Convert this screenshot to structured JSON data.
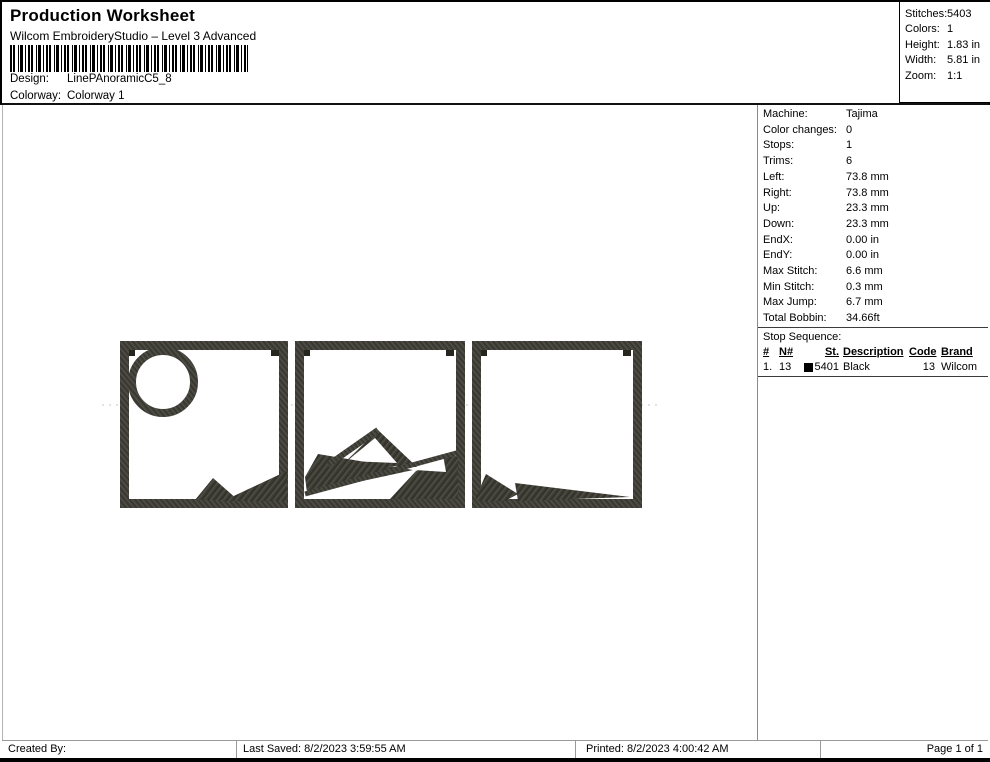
{
  "header": {
    "title": "Production Worksheet",
    "subtitle": "Wilcom EmbroideryStudio – Level 3 Advanced",
    "design_label": "Design:",
    "design_value": "LinePAnoramicC5_8",
    "colorway_label": "Colorway:",
    "colorway_value": "Colorway 1",
    "stats": [
      {
        "label": "Stitches:",
        "value": "5403"
      },
      {
        "label": "Colors:",
        "value": "1"
      },
      {
        "label": "Height:",
        "value": "1.83 in"
      },
      {
        "label": "Width:",
        "value": "5.81 in"
      },
      {
        "label": "Zoom:",
        "value": "1:1"
      }
    ]
  },
  "machine": {
    "rows": [
      {
        "label": "Machine:",
        "value": "Tajima"
      },
      {
        "label": "Color changes:",
        "value": "0"
      },
      {
        "label": "Stops:",
        "value": "1"
      },
      {
        "label": "Trims:",
        "value": "6"
      },
      {
        "label": "Left:",
        "value": "73.8 mm"
      },
      {
        "label": "Right:",
        "value": "73.8 mm"
      },
      {
        "label": "Up:",
        "value": "23.3 mm"
      },
      {
        "label": "Down:",
        "value": "23.3 mm"
      },
      {
        "label": "EndX:",
        "value": "0.00 in"
      },
      {
        "label": "EndY:",
        "value": "0.00 in"
      },
      {
        "label": "Max Stitch:",
        "value": "6.6 mm"
      },
      {
        "label": "Min Stitch:",
        "value": "0.3 mm"
      },
      {
        "label": "Max Jump:",
        "value": "6.7 mm"
      },
      {
        "label": "Total Bobbin:",
        "value": "34.66ft"
      }
    ],
    "stop_title": "Stop Sequence:",
    "table": {
      "headers": [
        "#",
        "N#",
        "St.",
        "Description",
        "Code",
        "Brand"
      ],
      "row": {
        "num": "1.",
        "n": "13",
        "swatch_color": "#000000",
        "swatch_style": "background:#000000",
        "st": "5401",
        "description": "Black",
        "code": "13",
        "brand": "Wilcom"
      }
    }
  },
  "design": {
    "description": "Three-panel panoramic embroidery: framed squares with sun circle, mountain peaks and foreground wedges",
    "thread_color": "#3c3c34",
    "panels": 3
  },
  "footer": {
    "created_by": "Created By:",
    "last_saved": "Last Saved: 8/2/2023 3:59:55 AM",
    "printed": "Printed: 8/2/2023 4:00:42 AM",
    "page": "Page 1 of 1"
  }
}
